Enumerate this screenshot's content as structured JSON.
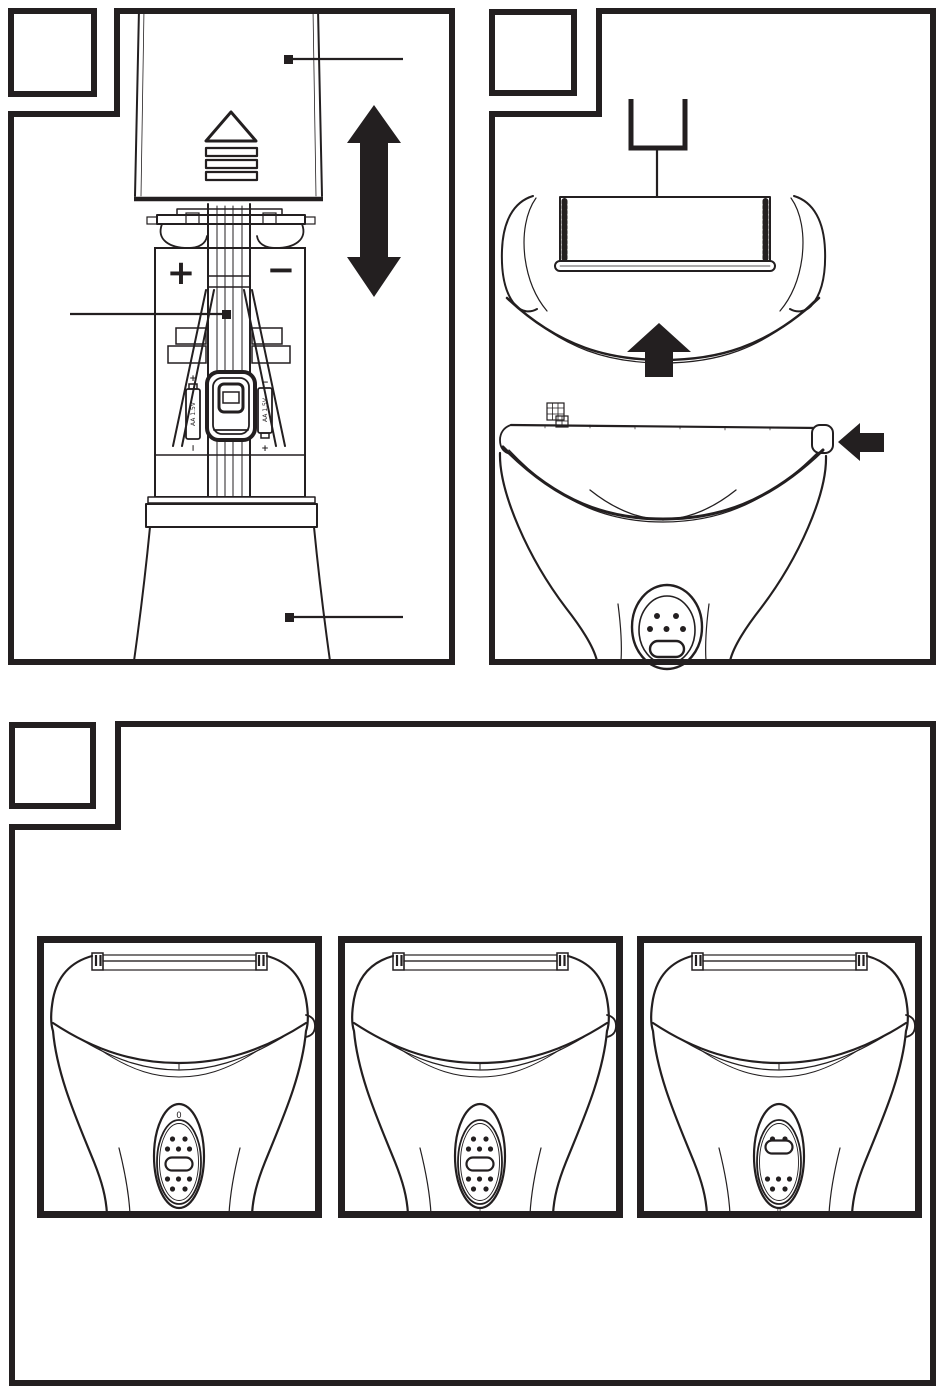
{
  "page": {
    "colors": {
      "ink": "#231f20",
      "paper": "#ffffff"
    },
    "description": "appliance instruction figures"
  },
  "figure1": {
    "label": "",
    "polarity_plus": "+",
    "polarity_minus": "−",
    "battery_left": {
      "label": "AA 1.5V",
      "terminal_top": "+",
      "terminal_bottom": "−"
    },
    "battery_right": {
      "label": "AA 1.5V",
      "terminal_top": "−",
      "terminal_bottom": "+"
    },
    "icons": {
      "cover_grip": "triangle-up-over-ridges",
      "move_arrow": "double-vertical-arrow"
    }
  },
  "figure2": {
    "label": "",
    "icons": {
      "attach_arrow": "arrow-up",
      "release_arrow": "arrow-left"
    }
  },
  "figure3": {
    "label": "",
    "positions": [
      {
        "label": "0",
        "pill_transform": "translate(0,0)"
      },
      {
        "label": "I",
        "pill_transform": "translate(0,0)"
      },
      {
        "label": "II",
        "pill_transform": "translate(0,-17)"
      }
    ]
  }
}
